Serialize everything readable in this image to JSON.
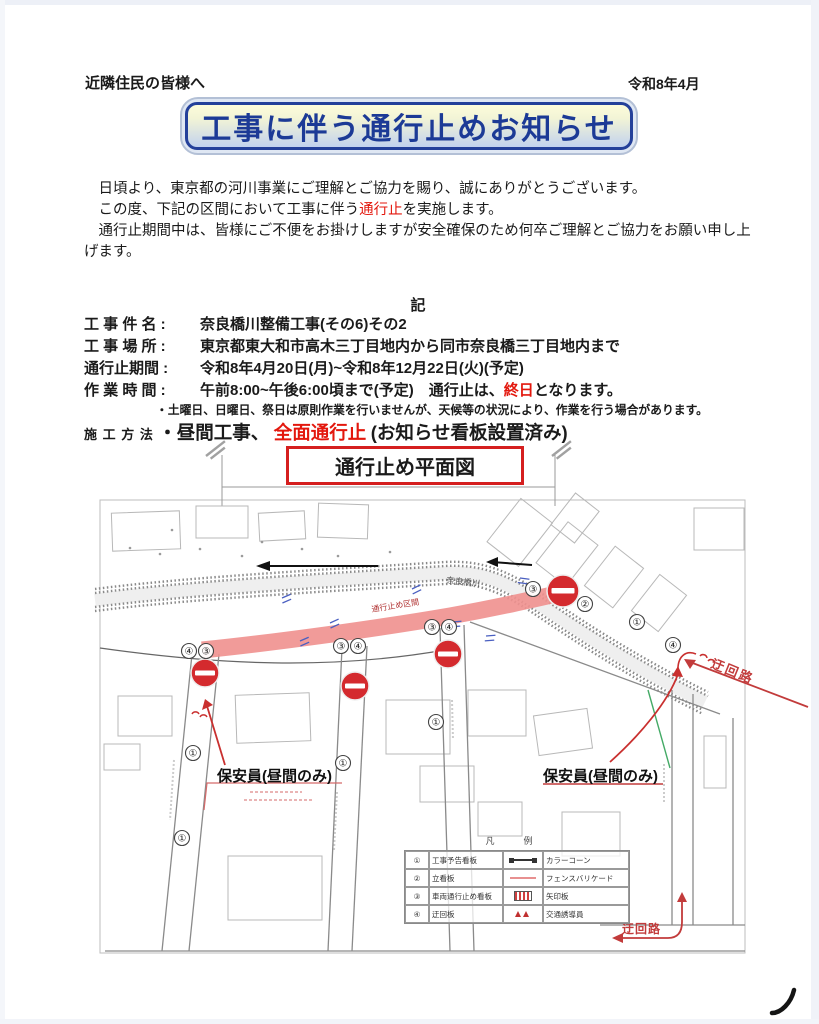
{
  "doc": {
    "salutation": "近隣住民の皆様へ",
    "date": "令和8年4月",
    "title": "工事に伴う通行止めお知らせ",
    "intro": {
      "line1": "　日頃より、東京都の河川事業にご理解とご協力を賜り、誠にありがとうございます。",
      "line2_pre": "　この度、下記の区間において工事に伴う",
      "line2_hl": "通行止",
      "line2_post": "を実施します。",
      "line3": "　通行止期間中は、皆様にご不便をお掛けしますが安全確保のため何卒ご理解とご協力をお願い申し上げます。"
    },
    "record_mark": "記",
    "details": [
      {
        "label": "工 事 件 名 :",
        "value": "奈良橋川整備工事(その6)その2"
      },
      {
        "label": "工 事 場 所 :",
        "value": "東京都東大和市高木三丁目地内から同市奈良橋三丁目地内まで"
      },
      {
        "label": "通行止期間 :",
        "value": "令和8年4月20日(月)~令和8年12月22日(火)(予定)"
      },
      {
        "label": "作 業 時 間 :",
        "value_pre": "午前8:00~午後6:00頃まで(予定)　通行止は、",
        "value_hl": "終日",
        "value_post": "となります。"
      }
    ],
    "note": "・土曜日、日曜日、祭日は原則作業を行いませんが、天候等の状況により、作業を行う場合があります。",
    "method_label": "施 工 方 法",
    "method_pre": "・昼間工事、",
    "method_hl": "全面通行止",
    "method_post": "(お知らせ看板設置済み)",
    "map_title": "通行止め平面図"
  },
  "map": {
    "river_label": "奈良橋川",
    "closed_section_label": "通行止め区間",
    "guard_left": "保安員(昼間のみ)",
    "guard_right": "保安員(昼間のみ)",
    "detour_right": "迂回路",
    "detour_bottom": "迂回路",
    "legend_title": "凡　例",
    "legend_rows": [
      {
        "num": "①",
        "name": "工事予告看板",
        "desc": "カラーコーン"
      },
      {
        "num": "②",
        "name": "立看板",
        "desc": "フェンスバリケード"
      },
      {
        "num": "③",
        "name": "車両通行止め看板",
        "desc": "矢印板"
      },
      {
        "num": "④",
        "name": "迂回板",
        "desc": "交通誘導員"
      }
    ],
    "markers": [
      {
        "label": "④"
      },
      {
        "label": "③"
      },
      {
        "label": "③"
      },
      {
        "label": "④"
      },
      {
        "label": "③"
      },
      {
        "label": "④"
      },
      {
        "label": "③"
      },
      {
        "label": "②"
      },
      {
        "label": "①"
      },
      {
        "label": "④"
      },
      {
        "label": "①"
      },
      {
        "label": "①"
      },
      {
        "label": "①"
      },
      {
        "label": "①"
      }
    ]
  }
}
